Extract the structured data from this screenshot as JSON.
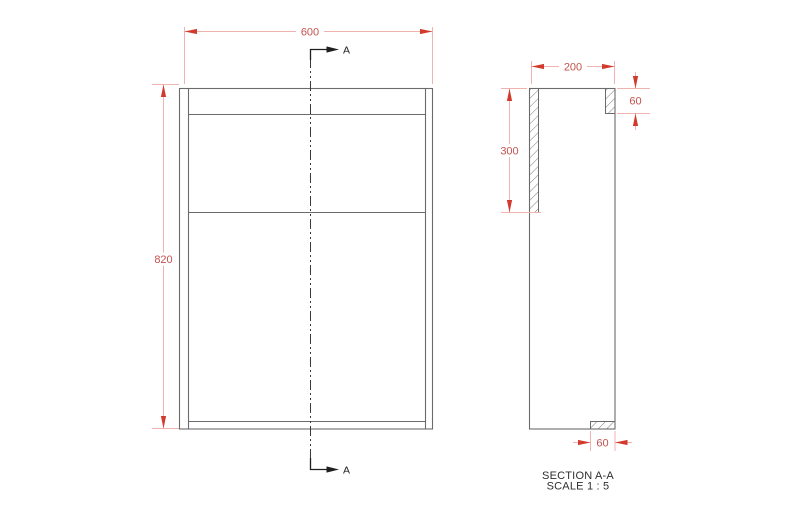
{
  "drawing": {
    "front_view": {
      "width_dim": "600",
      "height_dim": "820",
      "section_label_top": "A",
      "section_label_bottom": "A"
    },
    "section_view": {
      "depth_dim": "200",
      "side_panel_dim": "300",
      "top_rail_dim": "60",
      "bottom_rail_dim": "60",
      "title": "SECTION A-A",
      "scale": "SCALE 1 : 5"
    },
    "colors": {
      "outline_gray": "#6b6b6b",
      "dimension_line_pink": "#f0b3b0",
      "dimension_arrow_red": "#d13a2c",
      "dimension_text_red": "#c4524e",
      "section_marker_black": "#1f1f1f",
      "background": "#ffffff"
    }
  }
}
